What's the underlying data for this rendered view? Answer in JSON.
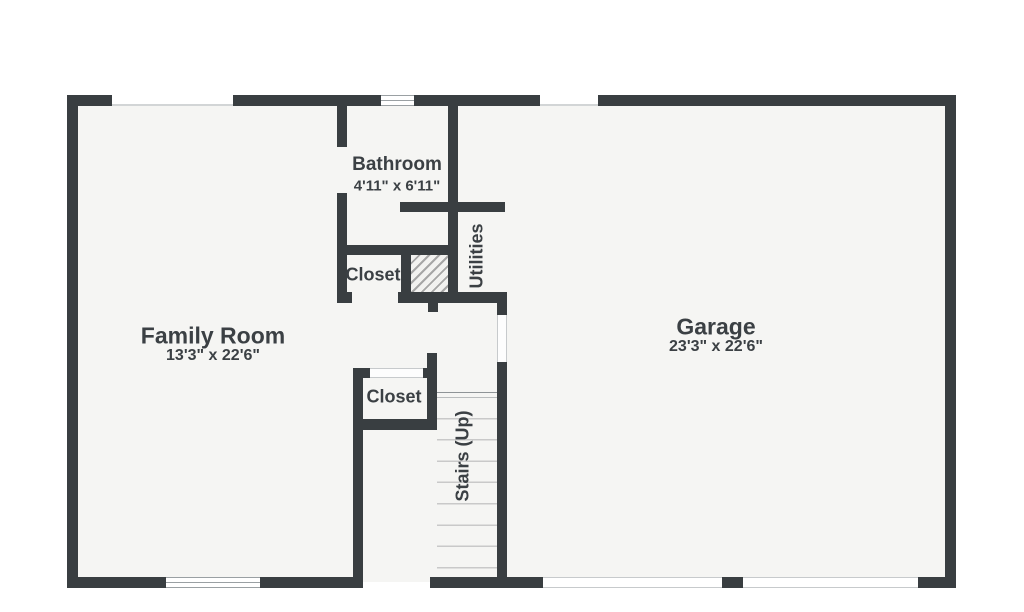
{
  "plan": {
    "rooms": {
      "bathroom": {
        "name": "Bathroom",
        "dims": "4'11\" x 6'11\""
      },
      "family_room": {
        "name": "Family Room",
        "dims": "13'3\" x 22'6\""
      },
      "garage": {
        "name": "Garage",
        "dims": "23'3\" x 22'6\""
      },
      "closet_upper": {
        "name": "Closet"
      },
      "closet_lower": {
        "name": "Closet"
      },
      "utilities": {
        "name": "Utilities"
      },
      "stairs": {
        "name": "Stairs (Up)"
      }
    },
    "colors": {
      "wall": "#393e41",
      "floor": "#f5f5f3",
      "label_text": "#3b4044",
      "stair_tread_line": "#c9c9c9",
      "hatch_line": "#a6a6a6",
      "window_line": "#9aa0a3"
    }
  }
}
